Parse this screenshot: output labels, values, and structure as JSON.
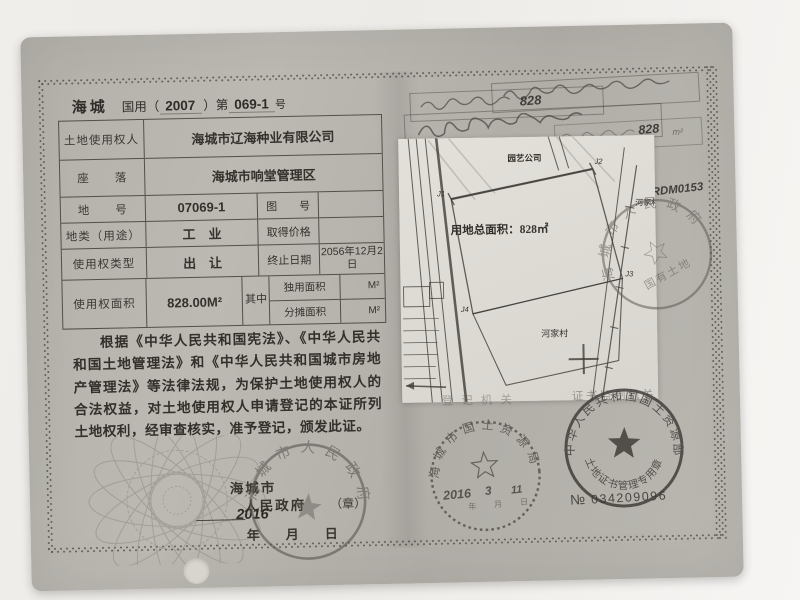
{
  "left_page": {
    "header": {
      "region": "海城",
      "type_prefix": "国用（",
      "year": "2007",
      "type_mid": "）第",
      "serial": "069-1",
      "suffix": "号"
    },
    "table": {
      "r1": {
        "label": "土地使用权人",
        "value": "海城市辽海种业有限公司"
      },
      "r2": {
        "label": "座　　落",
        "value": "海城市响堂管理区"
      },
      "r3": {
        "label": "地　　号",
        "value": "07069-1",
        "label2": "图　　号",
        "value2": ""
      },
      "r4": {
        "label": "地类（用途）",
        "value": "工　业",
        "label2": "取得价格",
        "value2": ""
      },
      "r5": {
        "label": "使用权类型",
        "value": "出　让",
        "label2": "终止日期",
        "value2": "2056年12月2日"
      },
      "r6": {
        "label": "使用权面积",
        "value": "828.00M²",
        "mid": "其中",
        "sub1_label": "独用面积",
        "sub1_unit": "M²",
        "sub2_label": "分摊面积",
        "sub2_unit": "M²"
      }
    },
    "statement": "根据《中华人民共和国宪法》、《中华人民共和国土地管理法》和《中华人民共和国城市房地产管理法》等法律法规，为保护土地使用权人的合法权益，对土地使用权人申请登记的本证所列土地权利，经审查核实，准予登记，颁发此证。",
    "issuer": {
      "name_part1": "海城市",
      "name_part2": "人民政府",
      "seal_mark": "（章）",
      "dash": "————",
      "year_hand": "2016",
      "date_template": "年　　月　　日"
    },
    "gov_stamp": {
      "ring_text": "海城市人民政府"
    }
  },
  "right_page": {
    "handwritten": {
      "box_value": "828",
      "area_value": "828",
      "area_unit": "m²",
      "code": "RDM0153"
    },
    "labels": {
      "registration_org": "登记机关",
      "supervision_org": "证书监制机关"
    },
    "map": {
      "company_label": "园艺公司",
      "area_text": "用地总面积：828㎡",
      "village_label": "河家村",
      "points": [
        "J1",
        "J2",
        "J3",
        "J4"
      ]
    },
    "seals": {
      "city_ring": "海城市人民政府",
      "city_inner": "国有土地",
      "bureau_ring": "海城市国土资源局",
      "bureau_date_year": "2016",
      "bureau_date_month": "3",
      "bureau_date_day": "11",
      "label_year": "年",
      "label_month": "月",
      "label_day": "日",
      "ministry_ring": "中华人民共和国国土资源部",
      "ministry_bottom": "土地证书管理专用章",
      "serial_label": "№",
      "serial_number": "034209096"
    }
  }
}
